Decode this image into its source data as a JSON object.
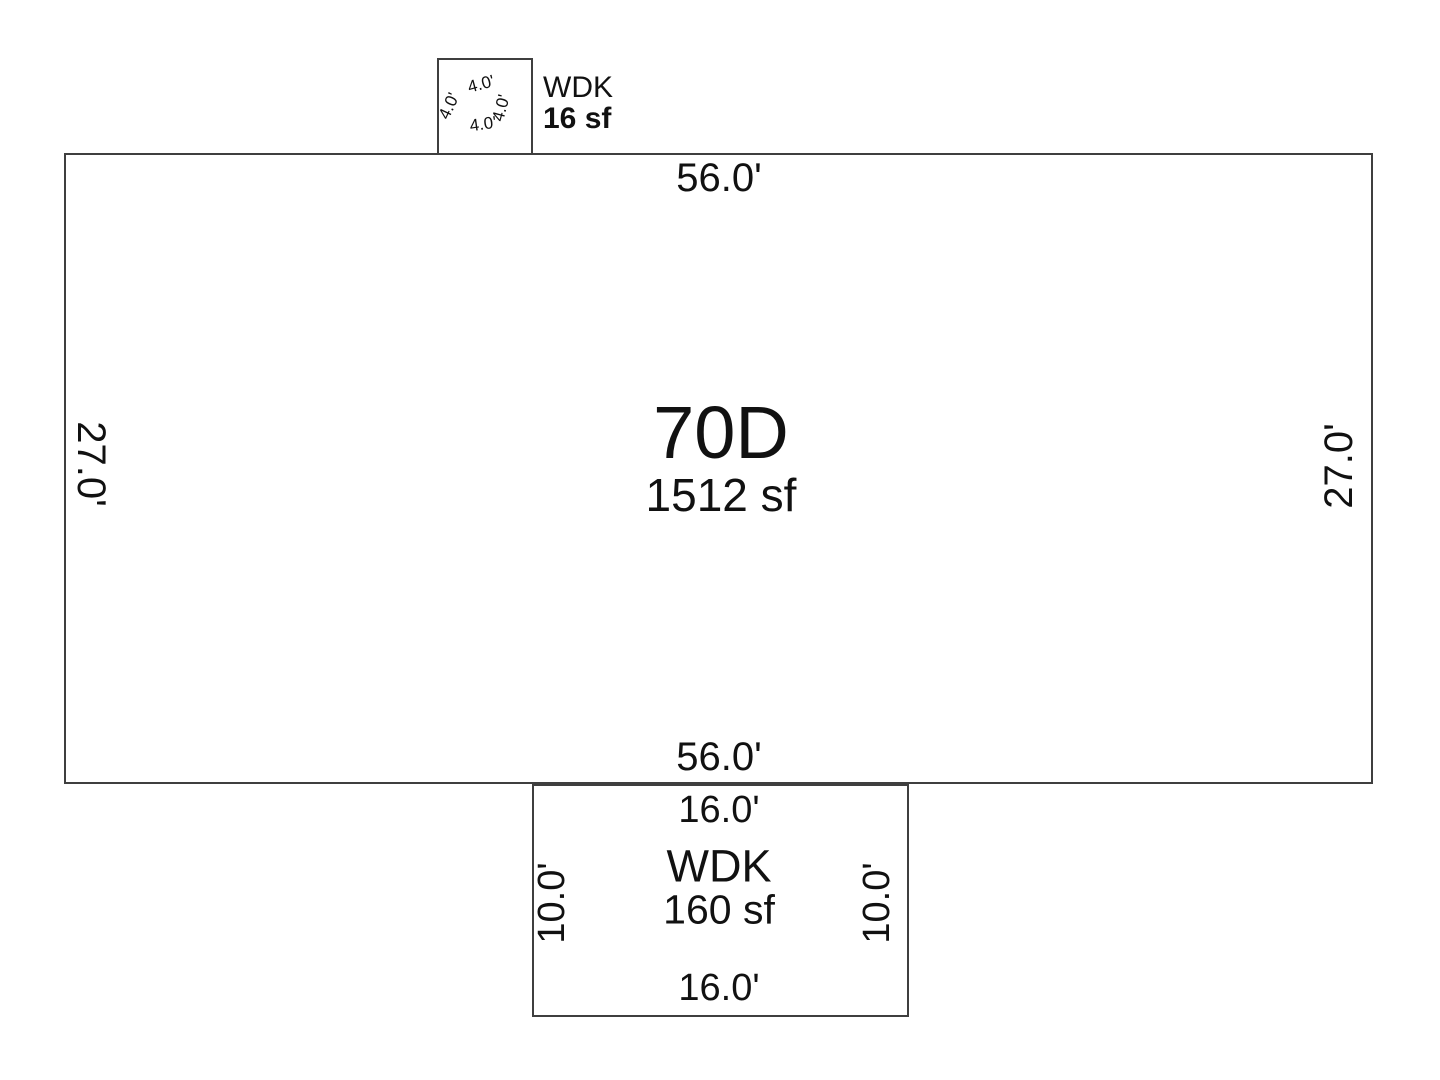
{
  "plan": {
    "main_unit": {
      "name": "70D",
      "area": "1512 sf",
      "dim_top": "56.0'",
      "dim_bottom": "56.0'",
      "dim_left": "27.0'",
      "dim_right": "27.0'"
    },
    "top_deck": {
      "name": "WDK",
      "area": "16 sf",
      "dim_top": "4.0'",
      "dim_right": "4.0'",
      "dim_bottom": "4.0'",
      "dim_left": "4.0'"
    },
    "bottom_deck": {
      "name": "WDK",
      "area": "160 sf",
      "dim_top": "16.0'",
      "dim_bottom": "16.0'",
      "dim_left": "10.0'",
      "dim_right": "10.0'"
    },
    "colors": {
      "line": "#3f3f3f",
      "text": "#111111",
      "background": "#ffffff"
    }
  }
}
